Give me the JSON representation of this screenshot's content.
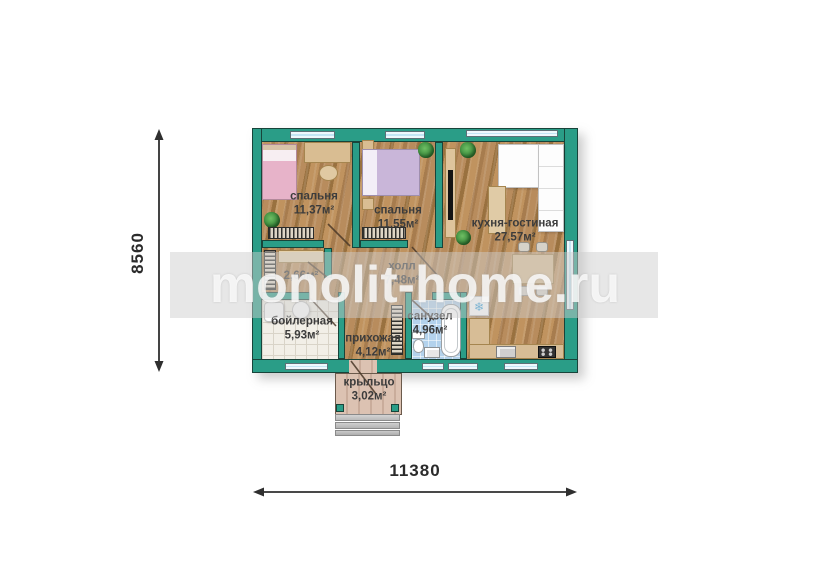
{
  "watermark": {
    "text": "monolit-home.ru"
  },
  "dimensions": {
    "height_label": "8560",
    "width_label": "11380"
  },
  "rooms": {
    "bedroom1": {
      "label": "спальня",
      "area": "11,37м²"
    },
    "bedroom2": {
      "label": "спальня",
      "area": "11,55м²"
    },
    "kitchen_living": {
      "label": "кухня-гостиная",
      "area": "27,57м²"
    },
    "hall": {
      "label": "холл",
      "area": "7,48м²"
    },
    "closet": {
      "area": "2,66м²"
    },
    "boiler": {
      "label": "бойлерная",
      "area": "5,93м²"
    },
    "entry": {
      "label": "прихожая",
      "area": "4,12м²"
    },
    "bathroom": {
      "label": "санузел",
      "area": "4,96м²"
    },
    "porch": {
      "label": "крыльцо",
      "area": "3,02м²"
    }
  },
  "icons": {
    "fridge_snowflake": "❄"
  },
  "colors": {
    "wall": "#2a9d87",
    "window": "#c3e6f4",
    "dimension_arrow": "#2f2f2f"
  }
}
